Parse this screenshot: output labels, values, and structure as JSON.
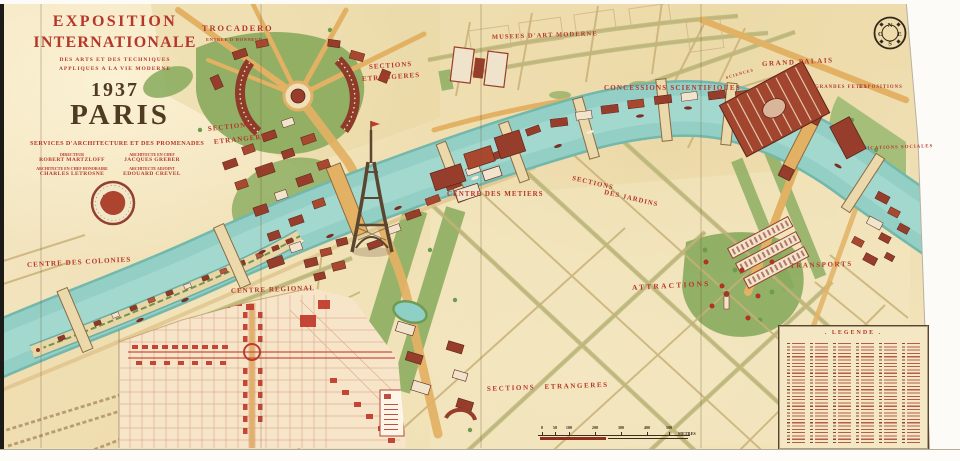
{
  "title": {
    "line1": "EXPOSITION",
    "line2": "INTERNATIONALE",
    "sub1": "DES ARTS ET DES TECHNIQUES",
    "sub2": "APPLIQUES A LA VIE MODERNE",
    "year": "1937",
    "city": "PARIS"
  },
  "services": {
    "heading": "SERVICES D'ARCHITECTURE ET DES PROMENADES",
    "credits": [
      {
        "role": "DIRECTEUR",
        "name": "ROBERT MARTZLOFF"
      },
      {
        "role": "ARCHITECTE EN CHEF",
        "name": "JACQUES GREBER"
      },
      {
        "role": "ARCHITECTE EN CHEF HONORAIRE",
        "name": "CHARLES LETROSNE"
      },
      {
        "role": "ARCHITECTE ADJOINT",
        "name": "EDOUARD CREVEL"
      }
    ]
  },
  "map_labels": {
    "trocadero": "TROCADERO",
    "entree": "ENTREE D'HONNEUR",
    "sections_nw1": "SECTIONS",
    "sections_nw2": "ETRANGERES",
    "musees": "MUSEES D'ART MODERNE",
    "concessions": "CONCESSIONS SCIENTIFIQUES",
    "grand_palais": "GRAND PALAIS",
    "sciences": "SCIENCES",
    "grandes_fetes": "GRANDES FETES",
    "expositions": "EXPOSITIONS",
    "sections_w1": "SECTIONS",
    "sections_w2": "ETRANGERES",
    "centre_metiers": "CENTRE DES METIERS",
    "jardins1": "SECTIONS",
    "jardins2": "DES JARDINS",
    "centre_colonies": "CENTRE DES COLONIES",
    "centre_regional": "CENTRE REGIONAL",
    "attractions": "ATTRACTIONS",
    "transports": "TRANSPORTS",
    "applications_sociales": "APPLICATIONS SOCIALES",
    "sections_sud": "SECTIONS ETRANGERES"
  },
  "legend": {
    "title": ". LEGENDE ."
  },
  "scale": {
    "ticks": [
      "0",
      "50",
      "100",
      "200",
      "300",
      "400",
      "500"
    ],
    "unit": "METRES"
  },
  "compass": {
    "n": "N",
    "e": "E",
    "s": "S",
    "o": "O"
  },
  "colors": {
    "paper": "#f2e3bc",
    "river": "#93cfc5",
    "label_red": "#b5372a",
    "building_red": "#963d2b",
    "park_green": "#87aa5c",
    "avenue_gold": "#e2b164",
    "inset_red": "#c0392b",
    "title_dark": "#4f3a22"
  }
}
